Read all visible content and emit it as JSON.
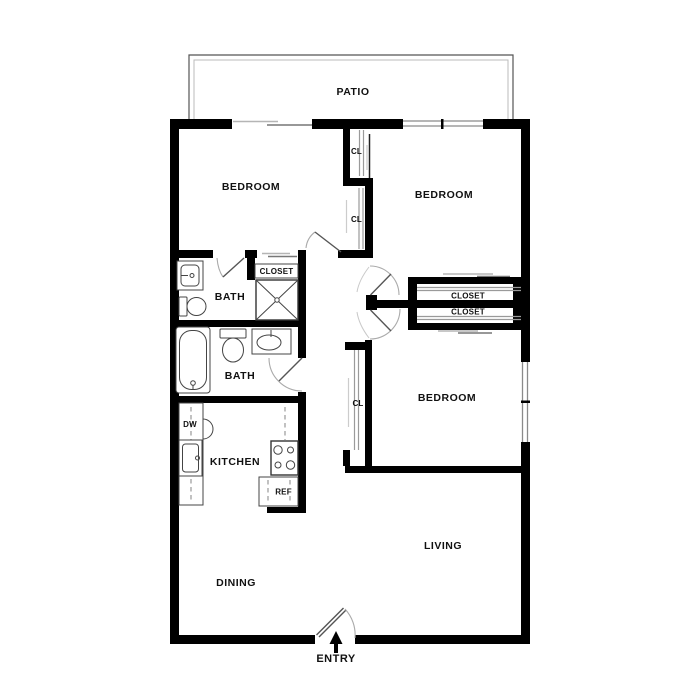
{
  "plan": {
    "patio": "PATIO",
    "entry": "ENTRY",
    "bedroom_top_left": "BEDROOM",
    "bedroom_top_right": "BEDROOM",
    "bedroom_bottom_right": "BEDROOM",
    "bath_upper": "BATH",
    "bath_lower": "BATH",
    "kitchen": "KITCHEN",
    "dining": "DINING",
    "living": "LIVING",
    "closet_hall_upper": "CL",
    "closet_hall_lower": "CL",
    "closet_bedroom3_cl": "CL",
    "closet_linen": "CLOSET",
    "closet_bedroom2": "CLOSET",
    "closet_bedroom3": "CLOSET",
    "dishwasher": "DW",
    "refrigerator": "REF"
  },
  "colors": {
    "background": "#ffffff",
    "wall": "#000000",
    "fixture_line": "#444444",
    "door_swing": "#aaaaaa",
    "window_line": "#8a8a8a",
    "label_text": "#111111"
  }
}
